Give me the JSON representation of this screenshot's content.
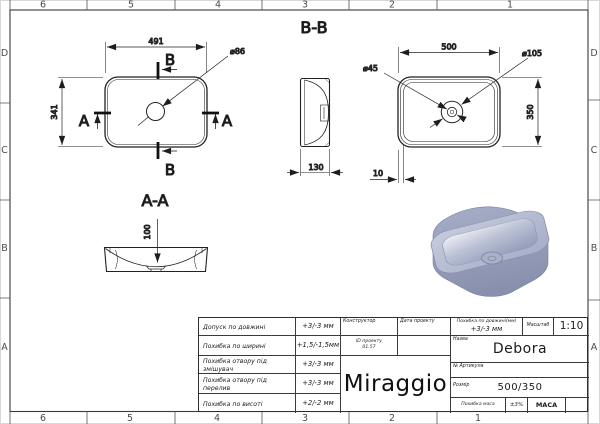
{
  "zones": {
    "cols": [
      "6",
      "5",
      "4",
      "3",
      "2",
      "1"
    ],
    "rows": [
      "D",
      "C",
      "B",
      "A"
    ]
  },
  "views": {
    "plan_left": {
      "width": "491",
      "height": "341",
      "hole": "⌀86",
      "sec_b": "B",
      "sec_a": "A"
    },
    "section_aa": {
      "title": "A-A",
      "depth": "100"
    },
    "section_bb": {
      "title": "B-B",
      "width": "130"
    },
    "plan_right": {
      "width": "500",
      "height": "350",
      "hole_outer": "⌀105",
      "hole_inner": "⌀45",
      "rim": "10"
    }
  },
  "titleblock": {
    "rows": [
      {
        "label": "Допуск по довжині",
        "value": "+3/-3 мм"
      },
      {
        "label": "Похибка по ширині",
        "value": "+1,5/-1,5мм"
      },
      {
        "label": "Похибка отвору під змішувач",
        "value": "+3/-3 мм"
      },
      {
        "label": "Похибка отвору під перелив",
        "value": "+3/-3 мм"
      },
      {
        "label": "Похибка по висоті",
        "value": "+2/-2 мм"
      }
    ],
    "constructor": "Конструктор",
    "date": "Дата проекту",
    "project_id": "ID проекту",
    "project_id_value": "01.57",
    "brand": "Miraggio",
    "len_tol_label": "Похибка по довжині(мм)",
    "len_tol_value": "+3/-3 мм",
    "scale_label": "Масштаб",
    "scale_value": "1:10",
    "name_label": "Назва",
    "name_value": "Debora",
    "article_label": "№ Артикула",
    "size_label": "Розмір",
    "size_value": "500/350",
    "mass_tol_label": "Похибка маса",
    "mass_tol_value": "±3%",
    "mass_label": "МАСА"
  }
}
